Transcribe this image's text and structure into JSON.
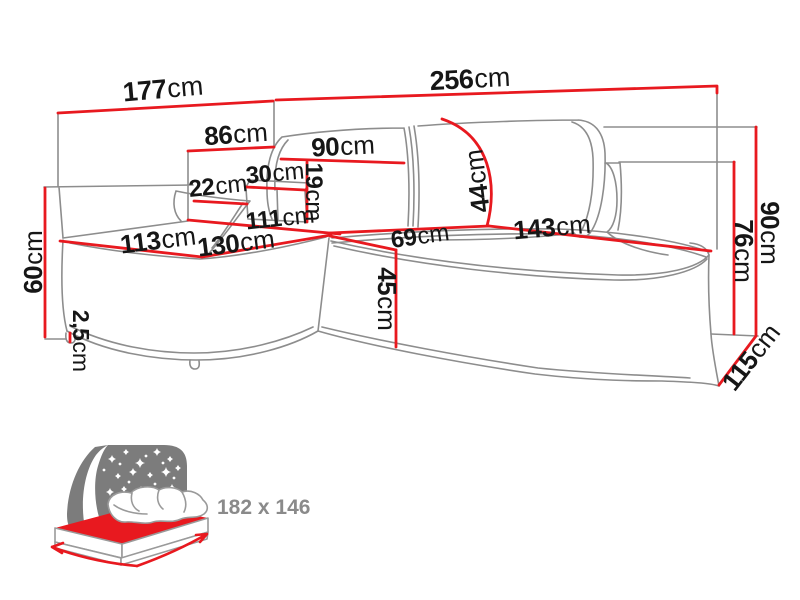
{
  "diagram": {
    "kind": "corner-sofa-dimension-drawing",
    "unit": "cm"
  },
  "colors": {
    "dimension_red": "#e8191f",
    "outline_gray": "#8d8d8d",
    "label_black": "#161616",
    "icon_gray": "#7c7c7c",
    "icon_text_gray": "#8a8a8a",
    "background": "#ffffff"
  },
  "dimensions": [
    {
      "id": "back-left-width",
      "value": "177",
      "unit": "cm",
      "x": 163,
      "y": 89,
      "rot": -5,
      "size": 27
    },
    {
      "id": "back-right-width",
      "value": "256",
      "unit": "cm",
      "x": 470,
      "y": 79,
      "rot": -3,
      "size": 27
    },
    {
      "id": "chaise-back-width",
      "value": "86",
      "unit": "cm",
      "x": 236,
      "y": 134,
      "rot": -4,
      "size": 26
    },
    {
      "id": "backrest-cushion-width",
      "value": "90",
      "unit": "cm",
      "x": 343,
      "y": 146,
      "rot": -3,
      "size": 26
    },
    {
      "id": "headrest-width",
      "value": "30",
      "unit": "cm",
      "x": 275,
      "y": 173,
      "rot": -5,
      "size": 24
    },
    {
      "id": "armrest-width",
      "value": "22",
      "unit": "cm",
      "x": 218,
      "y": 186,
      "rot": -6,
      "size": 24
    },
    {
      "id": "headrest-height",
      "value": "19",
      "unit": "cm",
      "x": 314,
      "y": 192,
      "rot": 90,
      "size": 24
    },
    {
      "id": "chaise-length",
      "value": "111",
      "unit": "cm",
      "x": 280,
      "y": 218,
      "rot": -6,
      "size": 24
    },
    {
      "id": "chaise-front-width",
      "value": "113",
      "unit": "cm",
      "x": 158,
      "y": 240,
      "rot": -7,
      "size": 26
    },
    {
      "id": "chaise-depth",
      "value": "130",
      "unit": "cm",
      "x": 236,
      "y": 243,
      "rot": -7,
      "size": 26
    },
    {
      "id": "seat-depth",
      "value": "69",
      "unit": "cm",
      "x": 420,
      "y": 236,
      "rot": -8,
      "size": 24
    },
    {
      "id": "seat-width",
      "value": "143",
      "unit": "cm",
      "x": 552,
      "y": 227,
      "rot": -5,
      "size": 26
    },
    {
      "id": "backrest-height",
      "value": "44",
      "unit": "cm",
      "x": 477,
      "y": 181,
      "rot": -97,
      "size": 26
    },
    {
      "id": "seat-front-height",
      "value": "45",
      "unit": "cm",
      "x": 387,
      "y": 299,
      "rot": 90,
      "size": 26
    },
    {
      "id": "chaise-side-height",
      "value": "60",
      "unit": "cm",
      "x": 33,
      "y": 262,
      "rot": -90,
      "size": 26
    },
    {
      "id": "leg-height",
      "value": "2,5",
      "unit": "cm",
      "x": 81,
      "y": 341,
      "rot": 90,
      "size": 23
    },
    {
      "id": "total-height",
      "value": "90",
      "unit": "cm",
      "x": 770,
      "y": 233,
      "rot": 90,
      "size": 26
    },
    {
      "id": "arm-height",
      "value": "76",
      "unit": "cm",
      "x": 744,
      "y": 251,
      "rot": 90,
      "size": 26
    },
    {
      "id": "side-depth",
      "value": "115",
      "unit": "cm",
      "x": 751,
      "y": 357,
      "rot": -52,
      "size": 26
    }
  ],
  "sleeping_icon": {
    "label": "182 x 146"
  }
}
